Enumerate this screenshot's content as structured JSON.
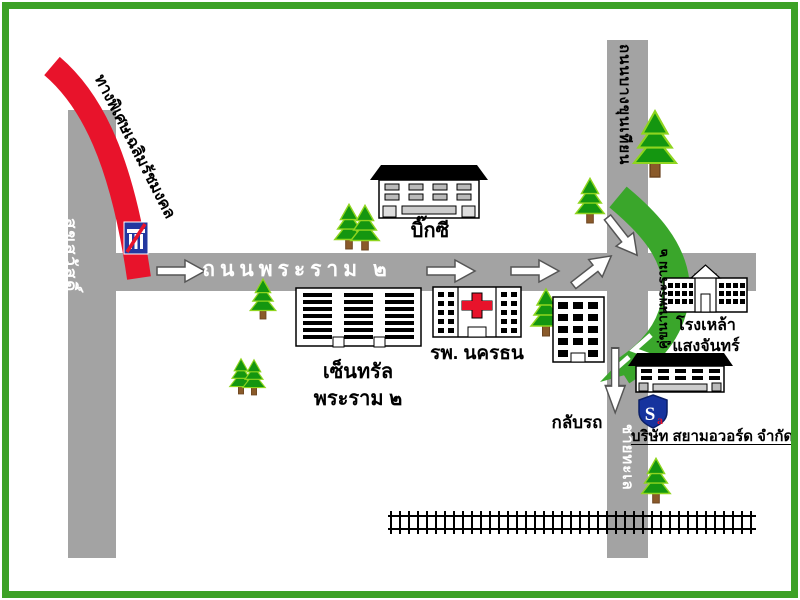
{
  "roads": {
    "main_road_label": "ถนนพระราม ๒",
    "left_road_label": "สุขสวัสดิ์",
    "top_right_road_label": "ถนนบางขุนเทียน",
    "bottom_right_road_label": "ชายทะเล",
    "expressway_label": "ทางพิเศษเฉลิมรัชมงคล",
    "frontage_road_label": "คู่ขนานพระราม ๒"
  },
  "places": {
    "bigc_label": "บิ๊กซี",
    "central_label_line1": "เซ็นทรัล",
    "central_label_line2": "พระราม ๒",
    "hospital_label": "รพ. นครธน",
    "distillery_label_line1": "โรงเหล้า",
    "distillery_label_line2": "แสงจันทร์",
    "company_label": "บริษัท สยามอวอร์ด จำกัด",
    "uturn_label": "กลับรถ"
  },
  "logo": {
    "letter_main": "S",
    "letter_sub": "a"
  },
  "colors": {
    "border_green": "#3ca126",
    "road_gray": "#a3a3a3",
    "expressway_red": "#e8132b",
    "frontage_green": "#3aa62b",
    "tree_green": "#149610",
    "tree_edge": "#8fd51f",
    "trunk_brown": "#8a5a2a",
    "sign_blue": "#2438a0",
    "cross_red": "#e8132b",
    "shield_blue": "#16339e"
  }
}
